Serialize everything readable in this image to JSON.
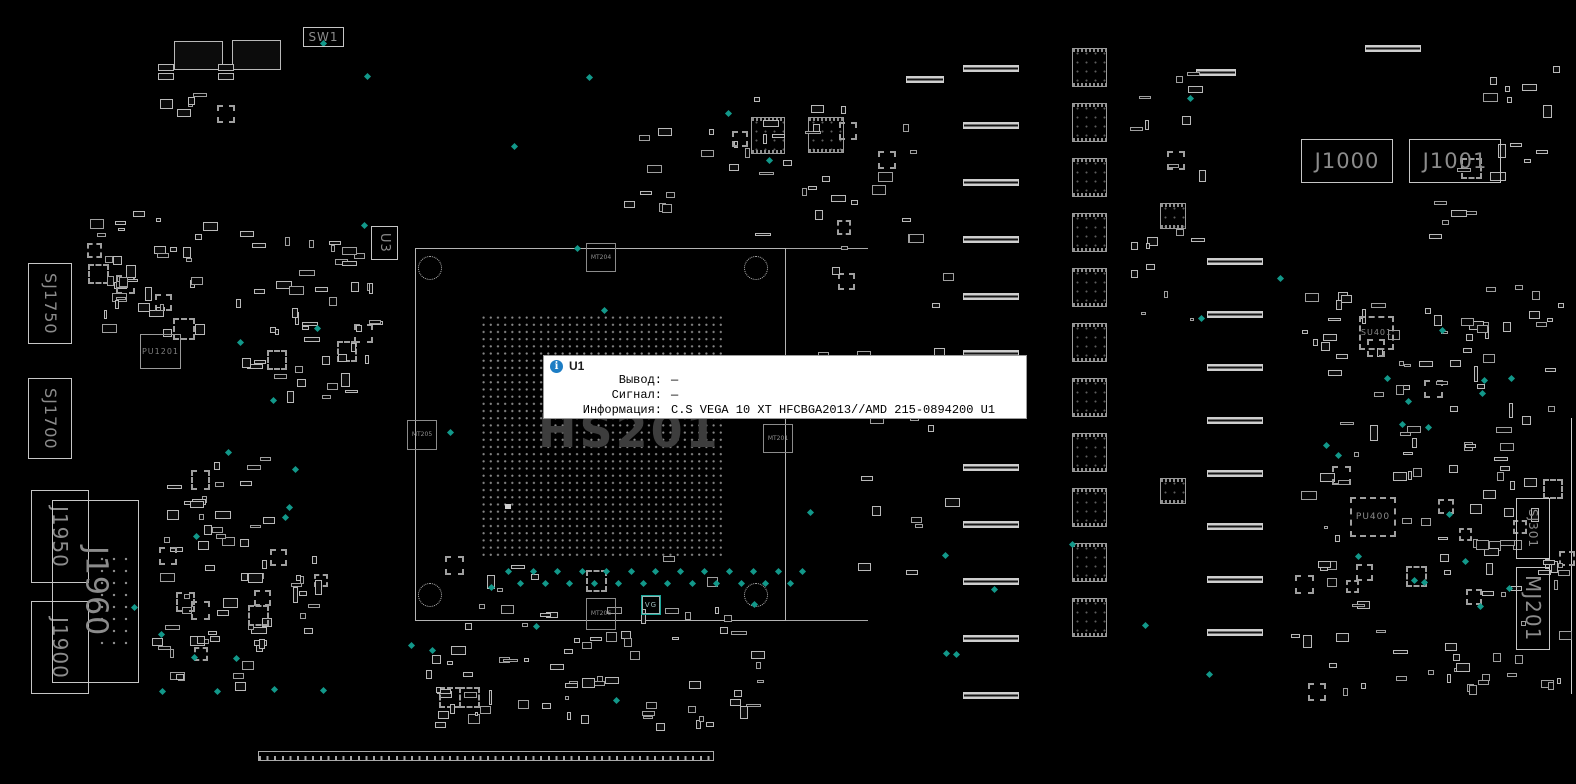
{
  "tooltip": {
    "title": "U1",
    "icon_glyph": "i",
    "rows": [
      {
        "label": "Вывод:",
        "value": "—"
      },
      {
        "label": "Сигнал:",
        "value": "—"
      },
      {
        "label": "Информация:",
        "value": "C.S VEGA 10 XT HFCBGA2013//AMD 215-0894200 U1"
      }
    ]
  },
  "board": {
    "watermark": "HS201",
    "colors": {
      "background": "#000000",
      "outline": "#9e9e9e",
      "bright_outline": "#c6c6c6",
      "label": "#8c8c8c",
      "watermark": "#3d3d3d",
      "testpoint": "#12988a",
      "tooltip_accent": "#1d7dc4"
    },
    "components": [
      {
        "id": "sw1",
        "label": "SW1",
        "x": 303,
        "y": 27,
        "w": 41,
        "h": 20,
        "type": "conn",
        "fs": 12,
        "dir": "h"
      },
      {
        "id": "u3",
        "label": "U3",
        "x": 371,
        "y": 226,
        "w": 27,
        "h": 34,
        "type": "conn",
        "fs": 13,
        "dir": "v"
      },
      {
        "id": "sj1750",
        "label": "SJ1750",
        "x": 28,
        "y": 263,
        "w": 44,
        "h": 81,
        "type": "conn",
        "fs": 16,
        "dir": "v"
      },
      {
        "id": "sj1700",
        "label": "SJ1700",
        "x": 28,
        "y": 378,
        "w": 44,
        "h": 81,
        "type": "conn",
        "fs": 16,
        "dir": "v"
      },
      {
        "id": "pu1201",
        "label": "PU1201",
        "x": 140,
        "y": 334,
        "w": 41,
        "h": 35,
        "type": "plain",
        "fs": 8,
        "dir": "h"
      },
      {
        "id": "j1950",
        "label": "J1950",
        "x": 31,
        "y": 490,
        "w": 58,
        "h": 93,
        "type": "conn",
        "fs": 20,
        "dir": "v"
      },
      {
        "id": "j1900",
        "label": "J1900",
        "x": 31,
        "y": 601,
        "w": 58,
        "h": 93,
        "type": "conn",
        "fs": 20,
        "dir": "v"
      },
      {
        "id": "j1960",
        "label": "J1960",
        "x": 52,
        "y": 500,
        "w": 87,
        "h": 183,
        "type": "conn",
        "fs": 30,
        "dir": "v",
        "dots": true
      },
      {
        "id": "mt204",
        "label": "MT204",
        "x": 586,
        "y": 243,
        "w": 30,
        "h": 29,
        "type": "marker",
        "fs": 6,
        "dir": "h"
      },
      {
        "id": "mt205",
        "label": "MT205",
        "x": 407,
        "y": 420,
        "w": 30,
        "h": 30,
        "type": "marker",
        "fs": 6,
        "dir": "h"
      },
      {
        "id": "mt201",
        "label": "MT201",
        "x": 763,
        "y": 424,
        "w": 30,
        "h": 29,
        "type": "marker",
        "fs": 6,
        "dir": "h"
      },
      {
        "id": "mt206",
        "label": "MT206",
        "x": 586,
        "y": 598,
        "w": 30,
        "h": 32,
        "type": "marker",
        "fs": 6,
        "dir": "h"
      },
      {
        "id": "vg",
        "label": "VG",
        "x": 642,
        "y": 596,
        "w": 18,
        "h": 18,
        "type": "hl",
        "fs": 7,
        "dir": "h"
      },
      {
        "id": "j1000",
        "label": "J1000",
        "x": 1301,
        "y": 139,
        "w": 92,
        "h": 44,
        "type": "conn",
        "fs": 21,
        "dir": "h"
      },
      {
        "id": "j1001",
        "label": "J1001",
        "x": 1409,
        "y": 139,
        "w": 92,
        "h": 44,
        "type": "conn",
        "fs": 21,
        "dir": "h"
      },
      {
        "id": "su401",
        "label": "SU401",
        "x": 1359,
        "y": 316,
        "w": 35,
        "h": 34,
        "type": "qfn",
        "fs": 8,
        "dir": "h"
      },
      {
        "id": "pu400",
        "label": "PU400",
        "x": 1350,
        "y": 497,
        "w": 46,
        "h": 40,
        "type": "qfn",
        "fs": 9,
        "dir": "h"
      },
      {
        "id": "sj301",
        "label": "SJ301",
        "x": 1516,
        "y": 498,
        "w": 34,
        "h": 61,
        "type": "conn",
        "fs": 12,
        "dir": "v"
      },
      {
        "id": "mj201",
        "label": "MJ201",
        "x": 1516,
        "y": 567,
        "w": 34,
        "h": 83,
        "type": "conn",
        "fs": 20,
        "dir": "v"
      }
    ]
  }
}
